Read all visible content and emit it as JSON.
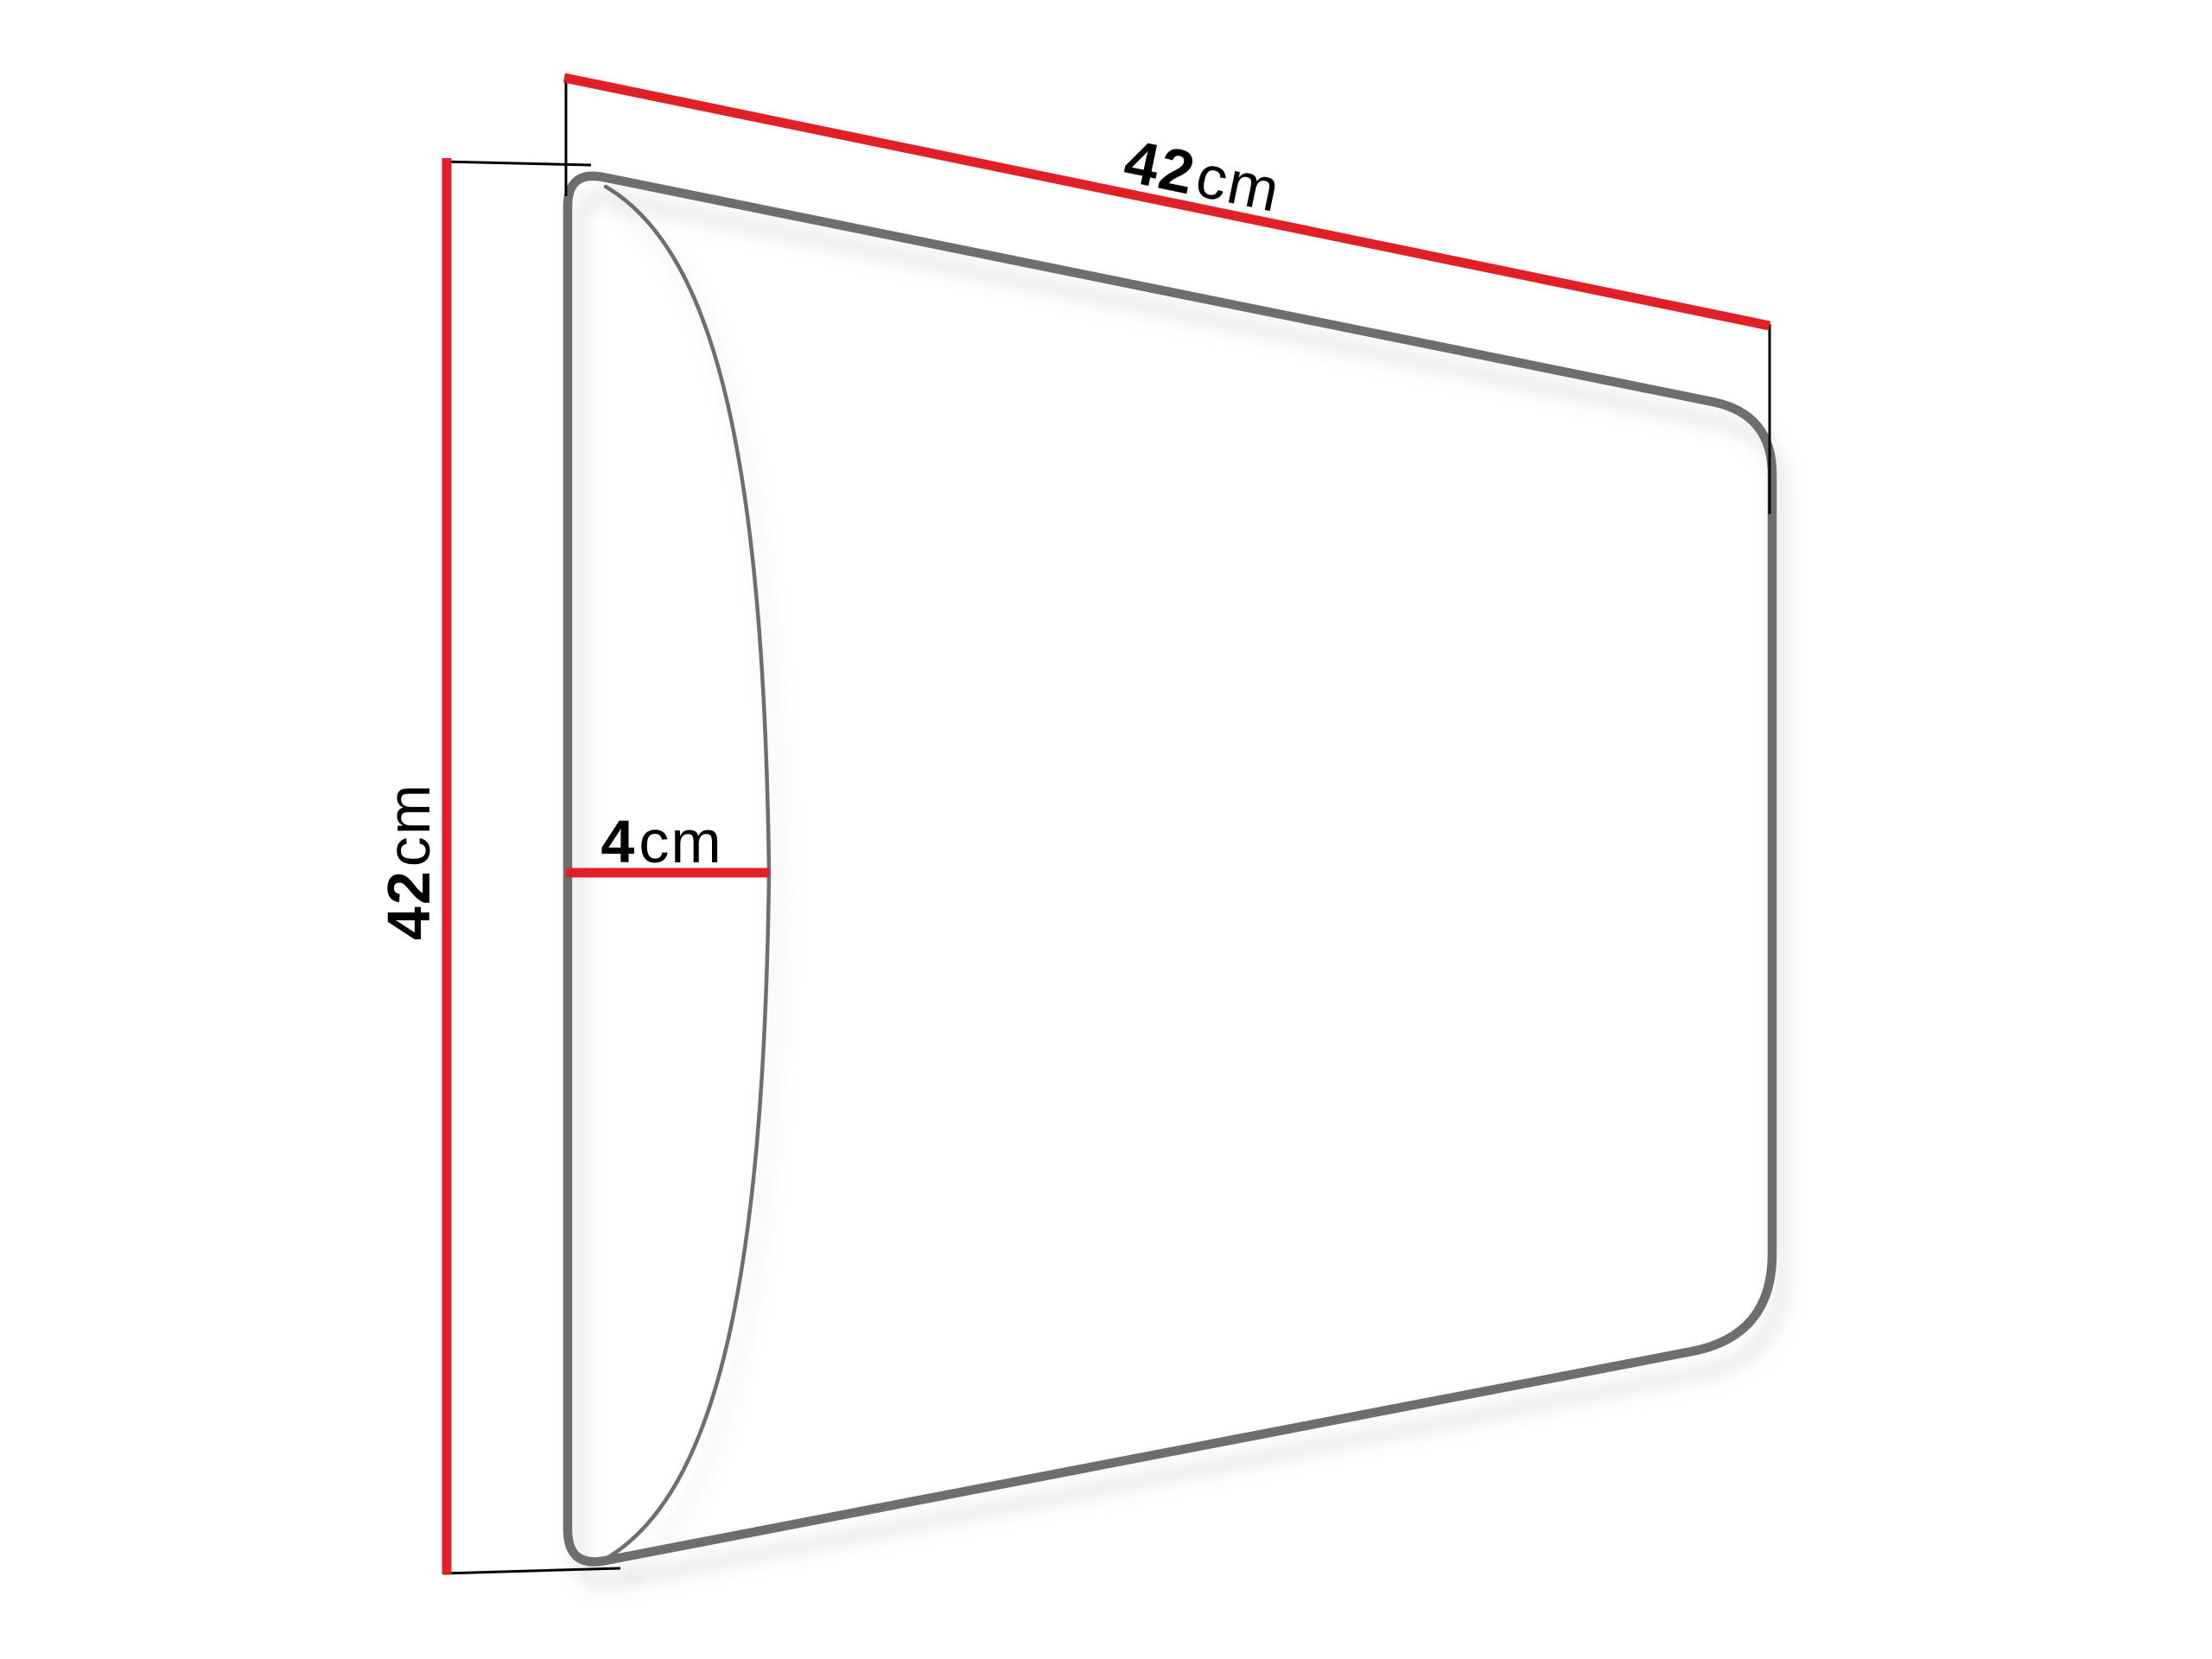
{
  "diagram": {
    "width_label": {
      "value": "42",
      "unit": "cm"
    },
    "height_label": {
      "value": "42",
      "unit": "cm"
    },
    "depth_label": {
      "value": "4",
      "unit": "cm"
    },
    "colors": {
      "dimension_line": "#e11f26",
      "panel_outline": "#6e6e6e",
      "extension_line": "#000000",
      "label_text": "#000000",
      "background": "#ffffff"
    }
  }
}
